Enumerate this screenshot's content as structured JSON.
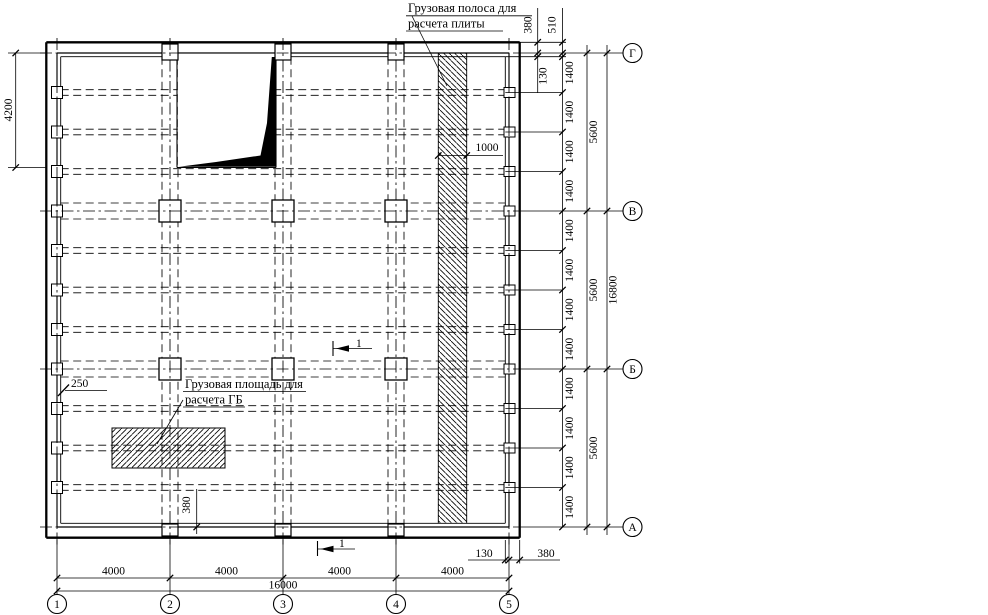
{
  "drawing": {
    "notes": {
      "strip_note_line1": "Грузовая полоса для",
      "strip_note_line2": "расчета плиты",
      "area_note_line1": "Грузовая площадь для",
      "area_note_line2": "расчета ГБ"
    },
    "callouts": {
      "strip_width": "1000",
      "left_offset": "250",
      "rib_offset": "380",
      "section_cut": "1"
    },
    "dimensions": {
      "top_wall": "380",
      "top_wall_plus_rib": "510",
      "right_first": "130",
      "right_ribs": [
        "1400",
        "1400",
        "1400",
        "1400",
        "1400",
        "1400",
        "1400",
        "1400",
        "1400",
        "1400",
        "1400",
        "1400"
      ],
      "right_bays": [
        "5600",
        "5600",
        "5600"
      ],
      "right_total": "16800",
      "left_opening": "4200",
      "bottom_bays": [
        "4000",
        "4000",
        "4000",
        "4000"
      ],
      "bottom_total": "16000",
      "bottom_first": "130",
      "bottom_wall": "380"
    },
    "grid_axes": {
      "bottom": [
        "1",
        "2",
        "3",
        "4",
        "5"
      ],
      "right": [
        "Г",
        "В",
        "Б",
        "А"
      ]
    },
    "colors": {
      "ink": "#000000",
      "paper": "#ffffff"
    }
  }
}
